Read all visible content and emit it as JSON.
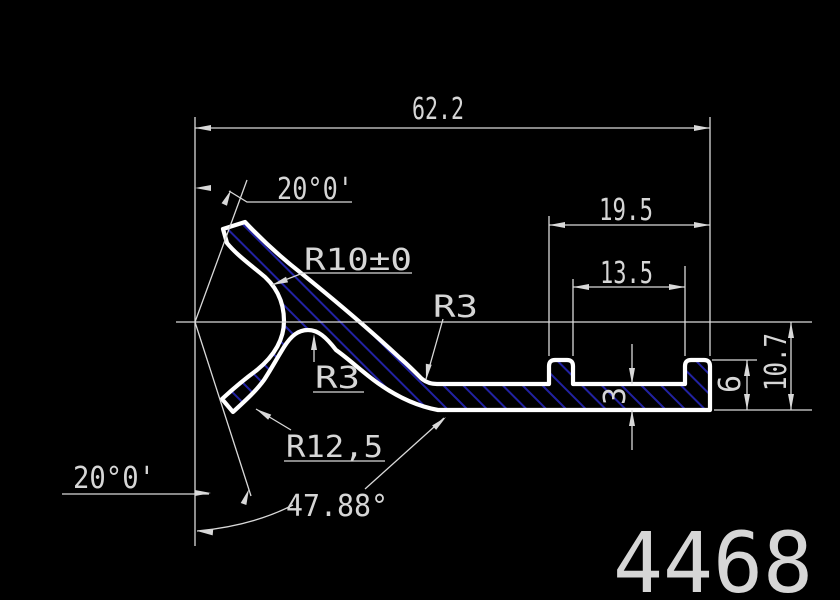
{
  "drawing": {
    "part_number": "4468",
    "dimensions": {
      "overall_width": "62.2",
      "angle_top": "20°0'",
      "radius_main": "R10±0",
      "radius_fillet_top": "R3",
      "radius_hump": "R3",
      "groove_outer": "19.5",
      "groove_inner": "13.5",
      "radius_lip": "R12,5",
      "web_thickness": "3",
      "ridge_height": "6",
      "total_height": "10.7",
      "angle_bottom": "20°0'",
      "angle_strut": "47.88°"
    },
    "colors": {
      "background": "#000000",
      "outline": "#ffffff",
      "dimension_lines": "#d9d9d9",
      "dimension_text": "#d6d6d6",
      "hatch": "#2222a2"
    }
  }
}
